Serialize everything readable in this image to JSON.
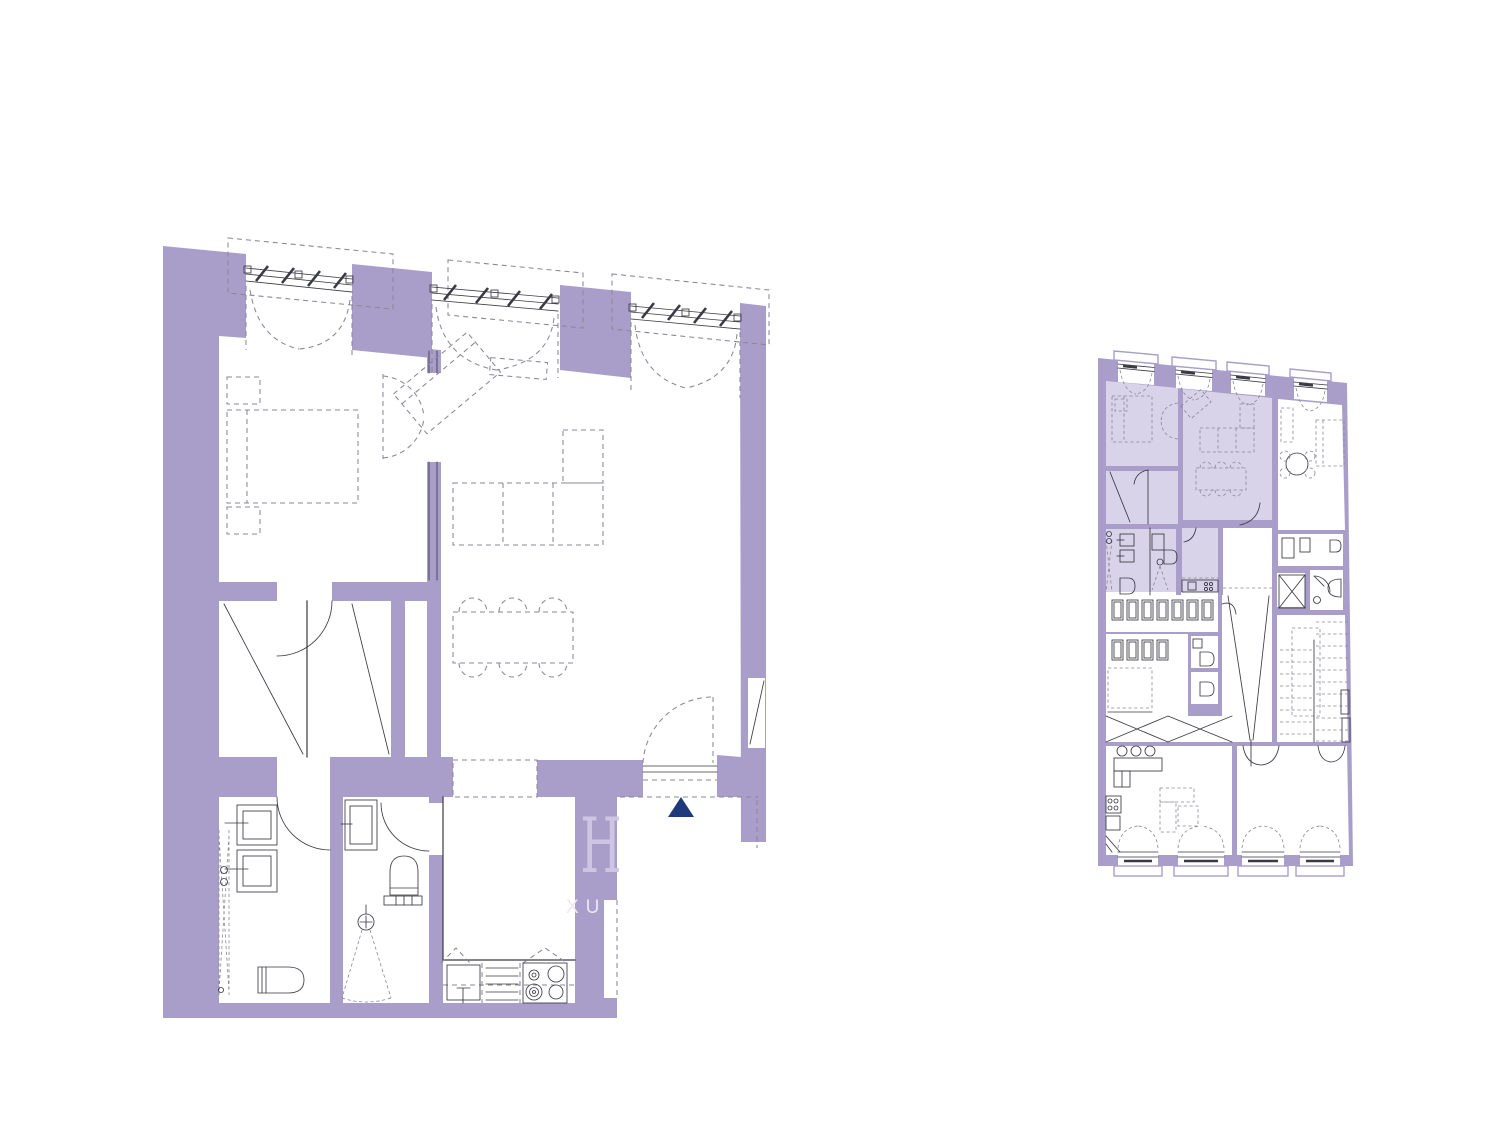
{
  "colors": {
    "wall": "#a89ec9",
    "highlight": "#d8d3e9",
    "room": "#ffffff",
    "line": "#3a3a44",
    "dash": "#8a8795",
    "marker": "#1e3a7b",
    "watermark": "#cec5e3",
    "watermark_text": "#ebe7f4"
  },
  "watermark": {
    "letter": "H",
    "partial_text": "XU"
  },
  "icons": {
    "entrance_marker": "filled-triangle-up"
  }
}
